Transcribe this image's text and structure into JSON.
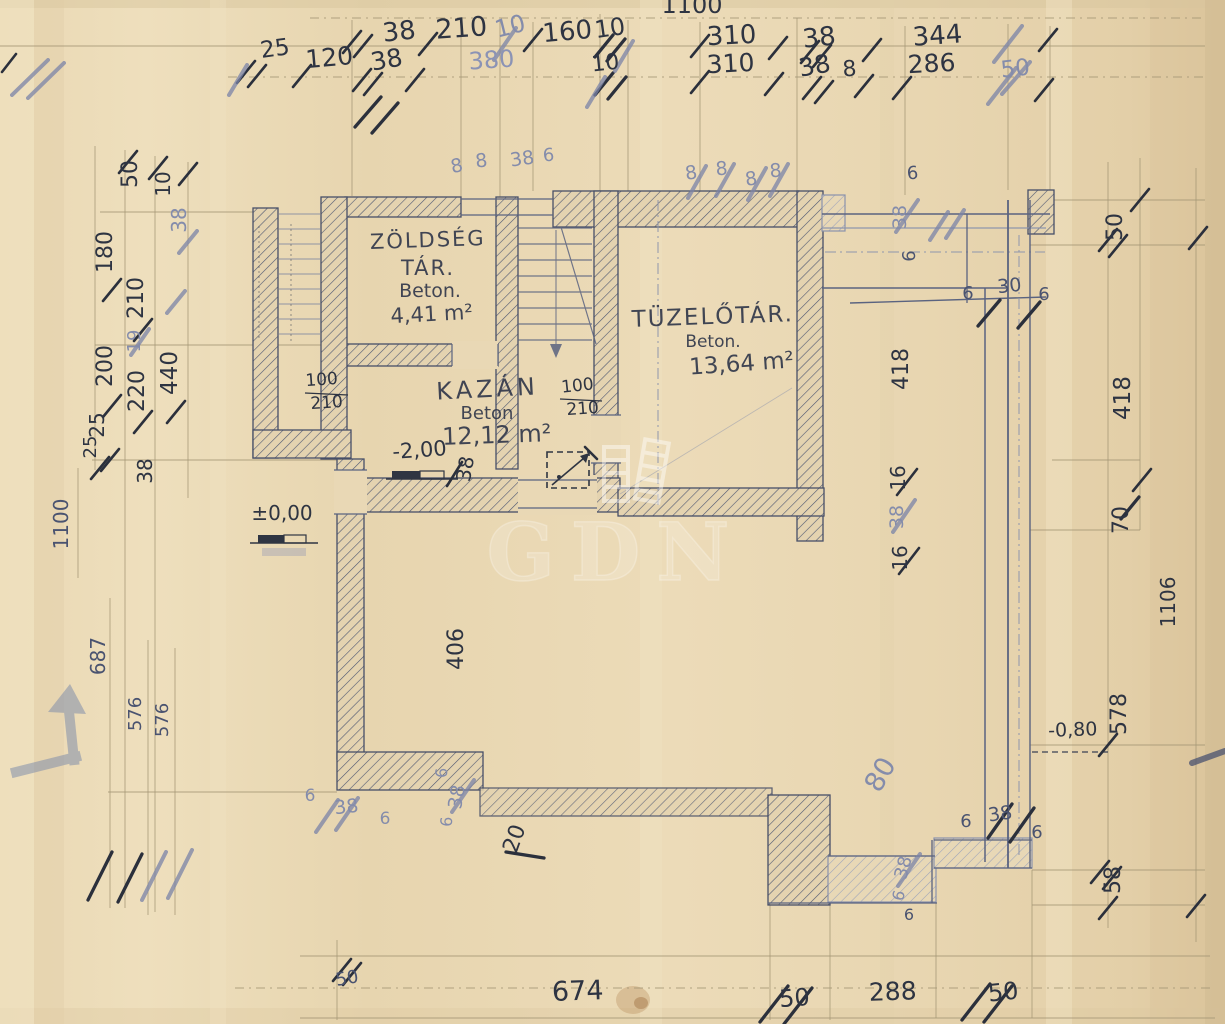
{
  "watermark": {
    "text": "GDN"
  },
  "rooms": {
    "zoldseg": {
      "name": "ZÖLDSÉG",
      "type": "TÁR.",
      "material": "Beton.",
      "area": "4,41 m²"
    },
    "kazan": {
      "name": "KAZÁN",
      "material": "Beton",
      "area": "12,12 m²"
    },
    "tuzelo": {
      "name": "TÜZELŐTÁR.",
      "material": "Beton.",
      "area": "13,64 m²"
    }
  },
  "levels": {
    "ground": "±0,00",
    "basement": "-2,00",
    "offset": "-0,80"
  },
  "doors": {
    "d1": {
      "w": "100",
      "h": "210"
    },
    "d2": {
      "w": "100",
      "h": "210"
    }
  },
  "dims": {
    "top_row1": [
      "1100",
      "38",
      "210",
      "10",
      "160",
      "10",
      "310",
      "38",
      "344"
    ],
    "top_row2": [
      "25",
      "120",
      "38",
      "380",
      "10",
      "310",
      "38",
      "8",
      "286",
      "50"
    ],
    "left_col": [
      "50",
      "10",
      "38",
      "180",
      "210",
      "200",
      "19",
      "220",
      "440",
      "25",
      "25",
      "38",
      "1100",
      "687",
      "576",
      "576"
    ],
    "right_col": [
      "50",
      "418",
      "70",
      "1106",
      "578",
      "58"
    ],
    "bottom_row": [
      "50",
      "674",
      "50",
      "288",
      "50"
    ],
    "inner_top": [
      "8",
      "8",
      "38",
      "6",
      "8",
      "8",
      "8",
      "8",
      "6"
    ],
    "inner_right": [
      "38",
      "6",
      "6",
      "30",
      "6",
      "418",
      "16",
      "38",
      "16"
    ],
    "inner_bottom": [
      "406",
      "6",
      "38",
      "6",
      "20",
      "6",
      "38",
      "6",
      "80",
      "6",
      "38",
      "6",
      "38",
      "6",
      "6"
    ],
    "near_level": [
      "38"
    ]
  }
}
